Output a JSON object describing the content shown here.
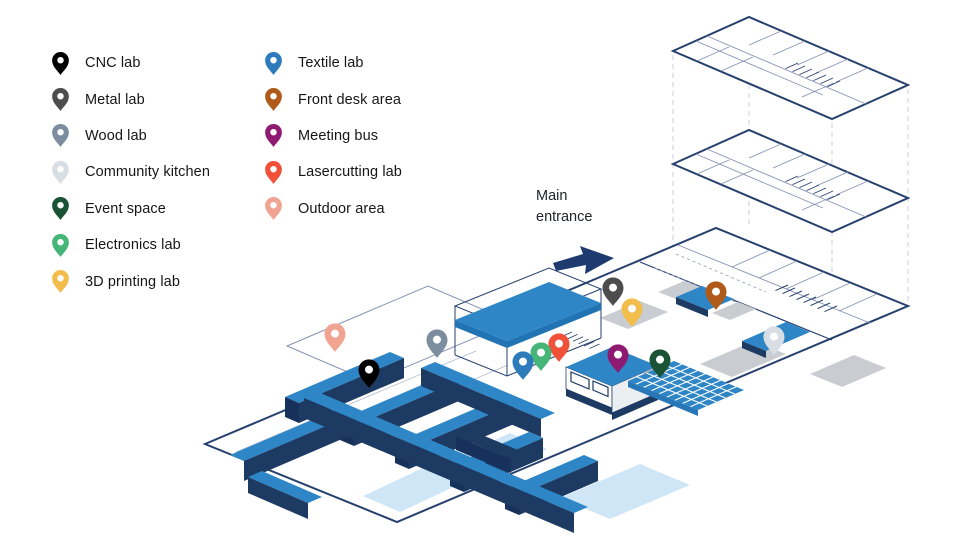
{
  "map": {
    "entrance_label": "Main entrance",
    "colors": {
      "outline_navy": "#26406e",
      "wall_front_navy": "#1d3a63",
      "wall_top_blue": "#2e86c6",
      "floor_light_blue": "#cfe6f7",
      "furniture_gray": "#c9cdd2",
      "connector_dash_gray": "#d9dde6",
      "arrow_navy": "#1e3a6e"
    },
    "pins": [
      {
        "id": "outdoor-area",
        "color": "#f2a492",
        "x": 335,
        "y": 352
      },
      {
        "id": "wood-lab",
        "color": "#7d8da0",
        "x": 437,
        "y": 358
      },
      {
        "id": "cnc-lab",
        "color": "#000000",
        "x": 369,
        "y": 388
      },
      {
        "id": "metal-lab",
        "color": "#4d4d4d",
        "x": 613,
        "y": 306
      },
      {
        "id": "3d-printing-lab",
        "color": "#f2bd4a",
        "x": 632,
        "y": 327
      },
      {
        "id": "front-desk-area",
        "color": "#b05a1a",
        "x": 716,
        "y": 310
      },
      {
        "id": "community-kitchen",
        "color": "#d9dee5",
        "x": 774,
        "y": 355
      },
      {
        "id": "lasercutting-lab",
        "color": "#f05138",
        "x": 559,
        "y": 362
      },
      {
        "id": "electronics-lab",
        "color": "#45b578",
        "x": 541,
        "y": 371
      },
      {
        "id": "textile-lab",
        "color": "#2e7bbc",
        "x": 523,
        "y": 380
      },
      {
        "id": "meeting-bus",
        "color": "#8e1a72",
        "x": 618,
        "y": 373
      },
      {
        "id": "event-space",
        "color": "#1a5336",
        "x": 660,
        "y": 378
      }
    ]
  },
  "legend": {
    "items": [
      {
        "id": "cnc-lab",
        "label": "CNC lab",
        "color": "#000000"
      },
      {
        "id": "metal-lab",
        "label": "Metal lab",
        "color": "#4d4d4d"
      },
      {
        "id": "wood-lab",
        "label": "Wood lab",
        "color": "#7d8da0"
      },
      {
        "id": "community-kitchen",
        "label": "Community kitchen",
        "color": "#d9dee5"
      },
      {
        "id": "event-space",
        "label": "Event space",
        "color": "#1a5336"
      },
      {
        "id": "electronics-lab",
        "label": "Electronics lab",
        "color": "#45b578"
      },
      {
        "id": "3d-printing-lab",
        "label": "3D printing lab",
        "color": "#f2bd4a"
      },
      {
        "id": "textile-lab",
        "label": "Textile lab",
        "color": "#2e7bbc"
      },
      {
        "id": "front-desk-area",
        "label": "Front desk area",
        "color": "#b05a1a"
      },
      {
        "id": "meeting-bus",
        "label": "Meeting bus",
        "color": "#8e1a72"
      },
      {
        "id": "lasercutting-lab",
        "label": "Lasercutting lab",
        "color": "#f05138"
      },
      {
        "id": "outdoor-area",
        "label": "Outdoor area",
        "color": "#f2a492"
      }
    ]
  }
}
